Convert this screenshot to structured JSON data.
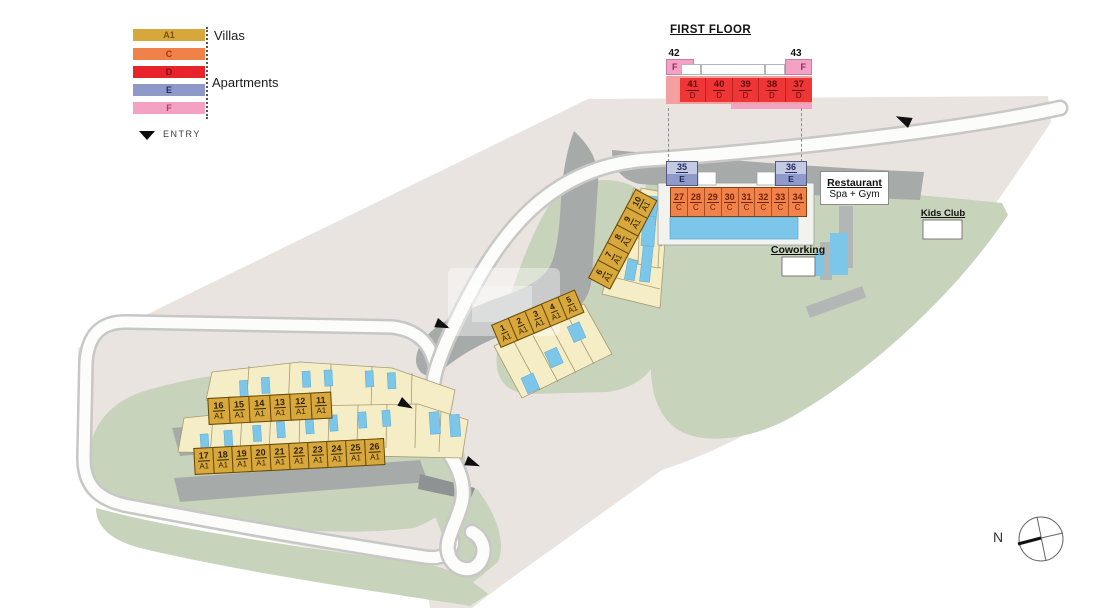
{
  "legend": {
    "items": [
      {
        "code": "A1",
        "color": "#d8a73b",
        "group": "Villas"
      },
      {
        "code": "C",
        "color": "#f08149",
        "group": "Apartments"
      },
      {
        "code": "D",
        "color": "#e7242c",
        "group": "Apartments"
      },
      {
        "code": "E",
        "color": "#8e99c9",
        "group": "Apartments"
      },
      {
        "code": "F",
        "color": "#f3a2c6",
        "group": "Apartments"
      }
    ],
    "villas_label": "Villas",
    "apartments_label": "Apartments",
    "entry_label": "ENTRY"
  },
  "first_floor": {
    "title": "FIRST FLOOR",
    "f_left": {
      "number": "42",
      "type": "F"
    },
    "f_right": {
      "number": "43",
      "type": "F"
    },
    "d_units": [
      {
        "number": "41",
        "type": "D"
      },
      {
        "number": "40",
        "type": "D"
      },
      {
        "number": "39",
        "type": "D"
      },
      {
        "number": "38",
        "type": "D"
      },
      {
        "number": "37",
        "type": "D"
      }
    ]
  },
  "units": {
    "villas_1_5": [
      {
        "number": "1",
        "type": "A1"
      },
      {
        "number": "2",
        "type": "A1"
      },
      {
        "number": "3",
        "type": "A1"
      },
      {
        "number": "4",
        "type": "A1"
      },
      {
        "number": "5",
        "type": "A1"
      }
    ],
    "villas_6_10": [
      {
        "number": "6",
        "type": "A1"
      },
      {
        "number": "7",
        "type": "A1"
      },
      {
        "number": "8",
        "type": "A1"
      },
      {
        "number": "9",
        "type": "A1"
      },
      {
        "number": "10",
        "type": "A1"
      }
    ],
    "villas_16_11": [
      {
        "number": "16",
        "type": "A1"
      },
      {
        "number": "15",
        "type": "A1"
      },
      {
        "number": "14",
        "type": "A1"
      },
      {
        "number": "13",
        "type": "A1"
      },
      {
        "number": "12",
        "type": "A1"
      },
      {
        "number": "11",
        "type": "A1"
      }
    ],
    "villas_17_26": [
      {
        "number": "17",
        "type": "A1"
      },
      {
        "number": "18",
        "type": "A1"
      },
      {
        "number": "19",
        "type": "A1"
      },
      {
        "number": "20",
        "type": "A1"
      },
      {
        "number": "21",
        "type": "A1"
      },
      {
        "number": "22",
        "type": "A1"
      },
      {
        "number": "23",
        "type": "A1"
      },
      {
        "number": "24",
        "type": "A1"
      },
      {
        "number": "25",
        "type": "A1"
      },
      {
        "number": "26",
        "type": "A1"
      }
    ],
    "apartments_c": [
      {
        "number": "27",
        "type": "C"
      },
      {
        "number": "28",
        "type": "C"
      },
      {
        "number": "29",
        "type": "C"
      },
      {
        "number": "30",
        "type": "C"
      },
      {
        "number": "31",
        "type": "C"
      },
      {
        "number": "32",
        "type": "C"
      },
      {
        "number": "33",
        "type": "C"
      },
      {
        "number": "34",
        "type": "C"
      }
    ],
    "apartment_e_left": {
      "number": "35",
      "type": "E"
    },
    "apartment_e_right": {
      "number": "36",
      "type": "E"
    }
  },
  "amenities": {
    "restaurant": "Restaurant",
    "spa_gym": "Spa + Gym",
    "coworking": "Coworking",
    "kids_club": "Kids Club"
  },
  "compass": {
    "north": "N"
  }
}
